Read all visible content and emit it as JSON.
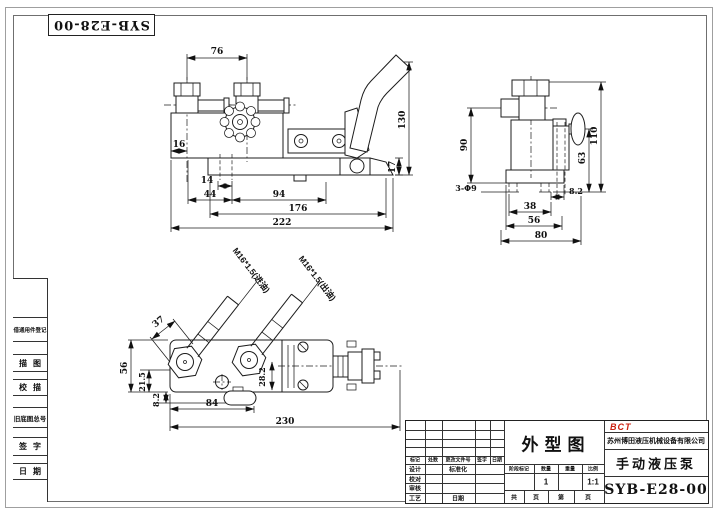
{
  "frame": {
    "drawing_no_top": "SYB-E28-00"
  },
  "left_strip": {
    "items": [
      "借通用件登记",
      "描图",
      "校描",
      "旧底图总号",
      "签字",
      "日期"
    ]
  },
  "dims": {
    "front": {
      "d76": "76",
      "d16": "16",
      "d14": "14",
      "d44": "44",
      "d94": "94",
      "d176": "176",
      "d222": "222",
      "d17": "17",
      "d130": "130"
    },
    "side": {
      "d90": "90",
      "d110": "110",
      "d63": "63",
      "holes": "3-Φ9",
      "d8_2": "8.2",
      "d38": "38",
      "d56": "56",
      "d80": "80"
    },
    "top": {
      "d37": "37",
      "d56": "56",
      "d21_5": "21.5",
      "d8_2": "8.2",
      "d28_2": "28.2",
      "d84": "84",
      "d230": "230",
      "inlet": "M16*1.5(进油)",
      "outlet": "M16*1.5(出油)"
    }
  },
  "title_block": {
    "logo": "BCT",
    "company": "苏州博田液压机械设备有限公司",
    "drawing_title": "外型图",
    "product_name": "手动液压泵",
    "drawing_no": "SYB-E28-00",
    "revision_headers": [
      "标记",
      "处数",
      "更改文件号",
      "签字",
      "日期"
    ],
    "role_labels": [
      "设计",
      "校对",
      "审核",
      "工艺"
    ],
    "standardization_label": "标准化",
    "date_label": "日期",
    "stage_headers": [
      "阶段标记",
      "数量",
      "重量",
      "比例"
    ],
    "quantity_value": "1",
    "scale_value": "1:1",
    "sheet_labels": [
      "共",
      "页",
      "第",
      "页"
    ]
  }
}
